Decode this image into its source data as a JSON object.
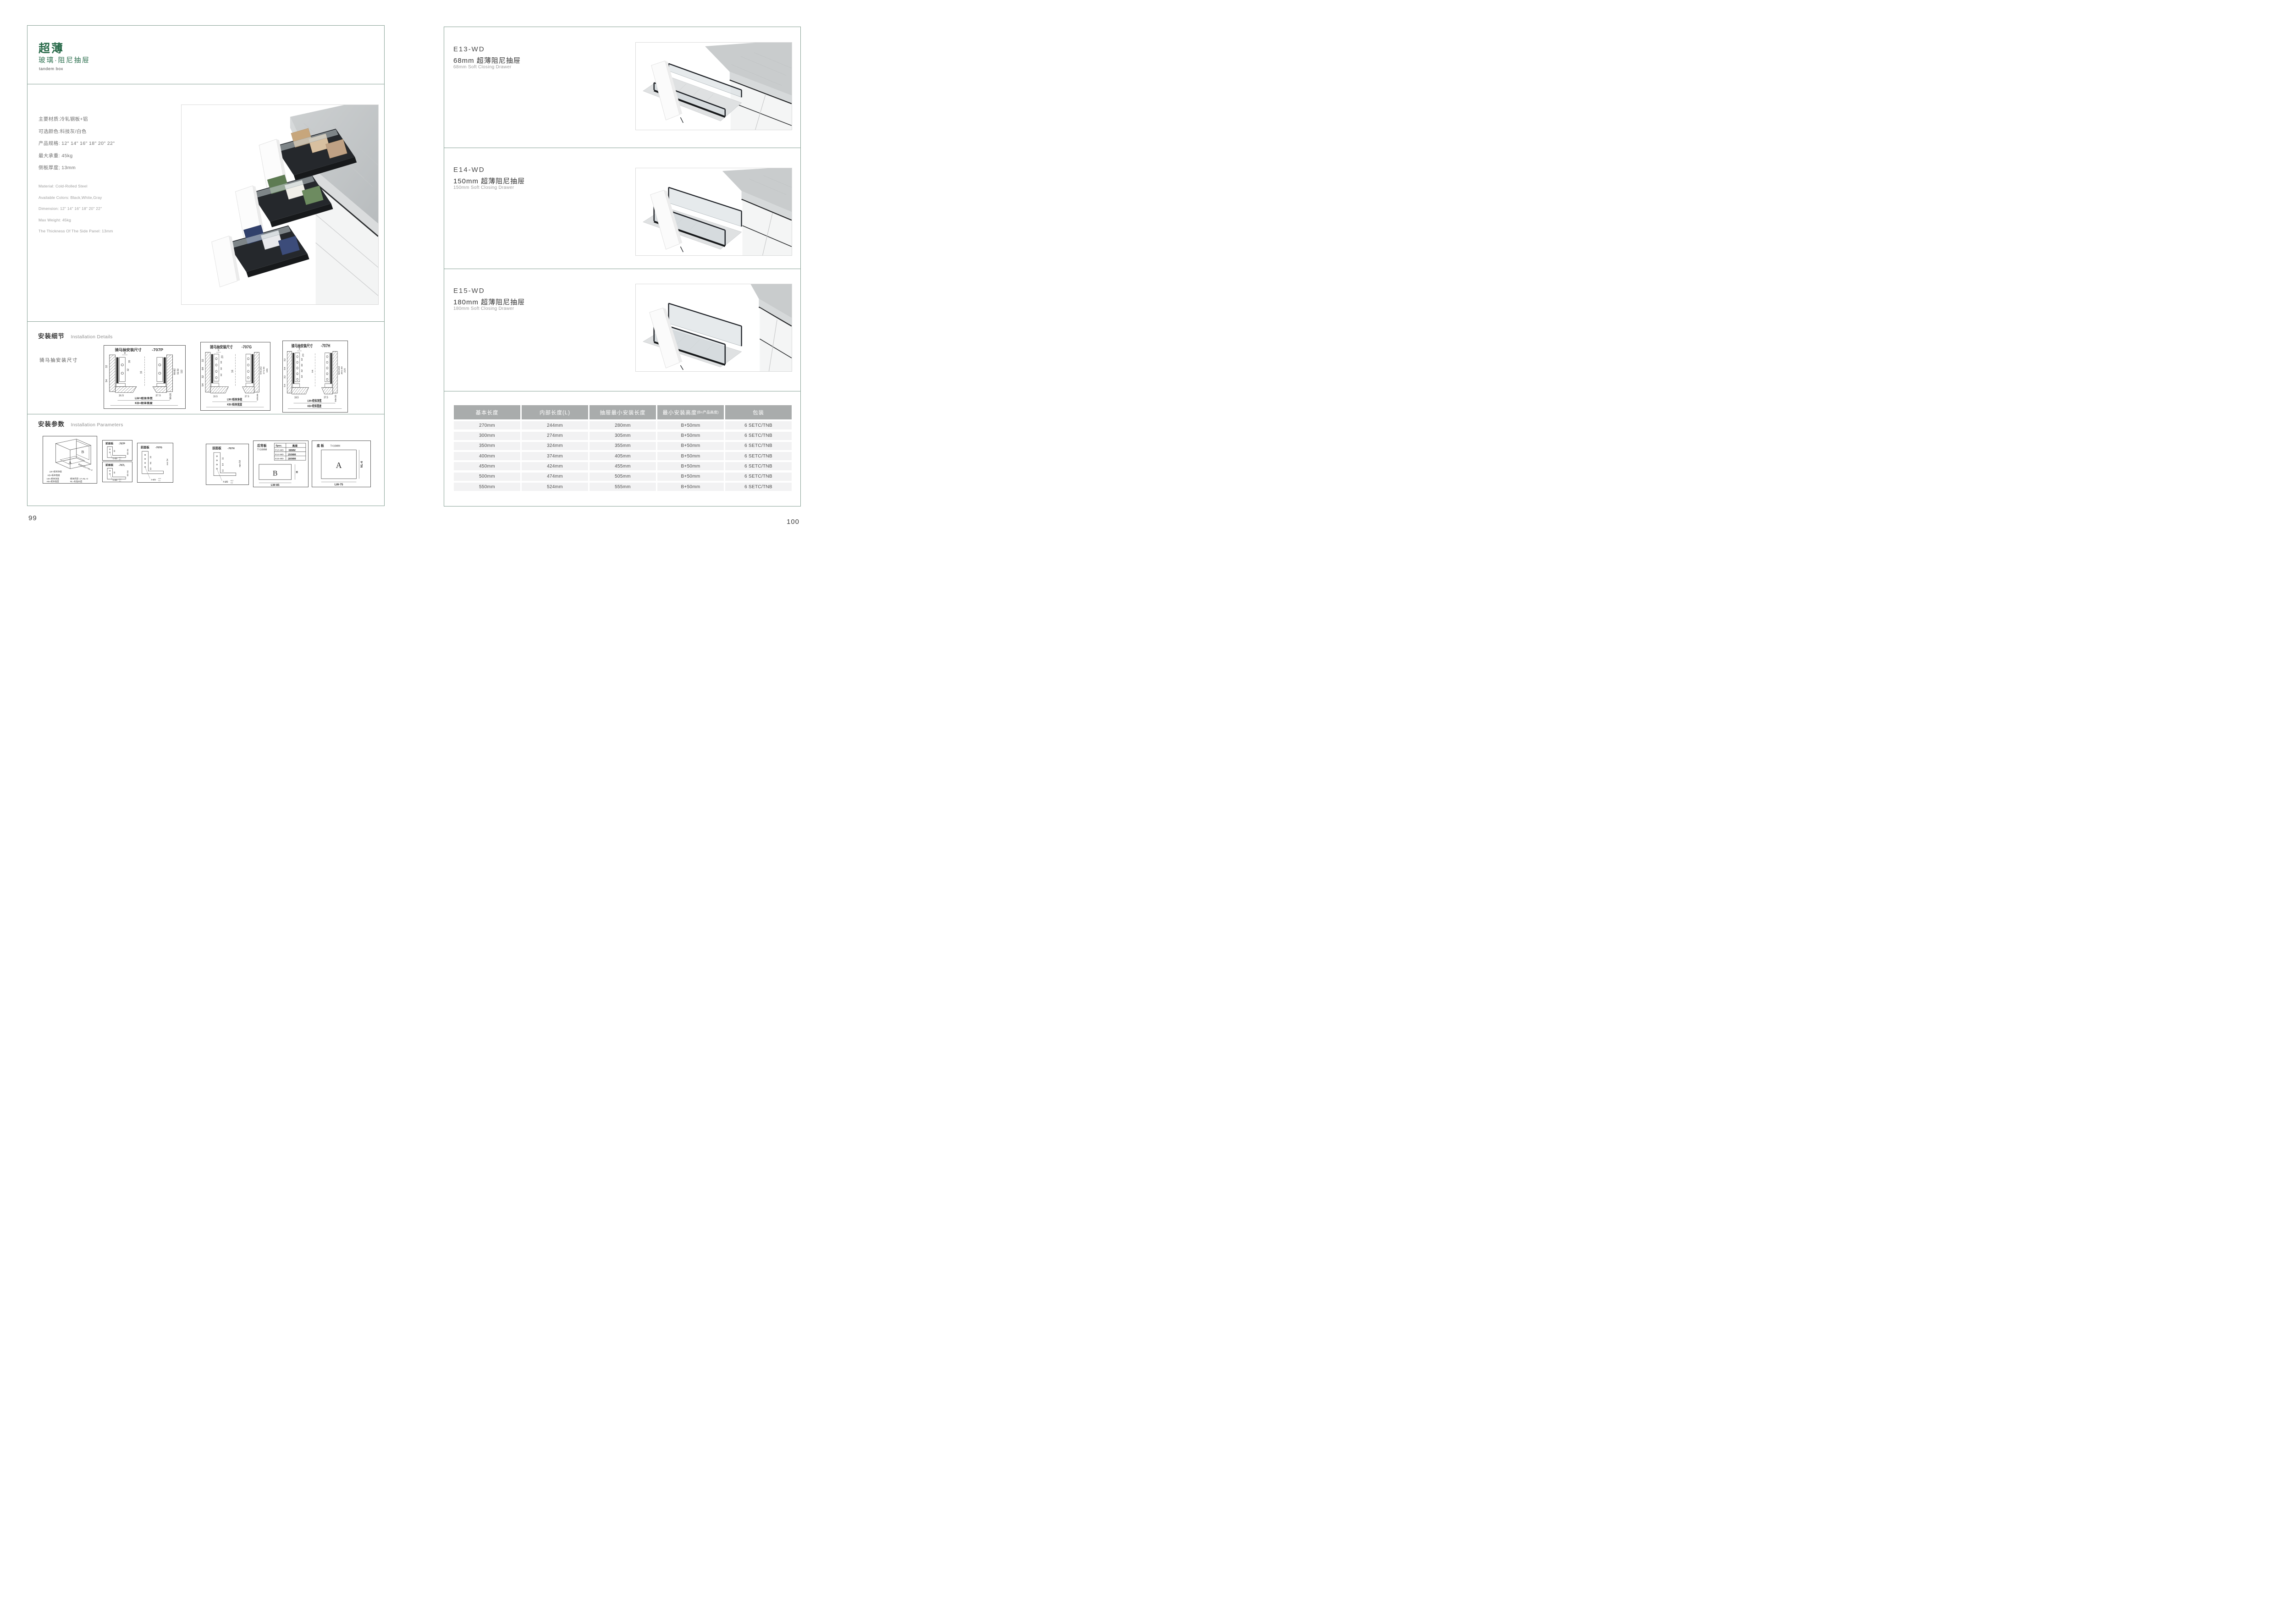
{
  "page": {
    "left_no": "99",
    "right_no": "100"
  },
  "colors": {
    "brand_green": "#2a6b4b",
    "border_green": "#86a094",
    "table_header_bg": "#a9acac",
    "table_row_bg": "#f2f2f3"
  },
  "left": {
    "header": {
      "title": "超薄",
      "subtitle": "玻璃·阻尼抽屉",
      "tagline": "tandem box"
    },
    "specs_cn": [
      "主要材质:冷轧钢板+铝",
      "可选颜色:科技灰/白色",
      "产品规格: 12\" 14\" 16\" 18\" 20\" 22\"",
      "最大承重: 45kg",
      "侧板厚度; 13mm"
    ],
    "specs_en": [
      "Material: Cold-Rolled Steel",
      "Available Colors: Black,White,Gray",
      "Dimension: 12\" 14\" 16\" 18\" 20\" 22\"",
      "Max Weight: 45kg",
      "The Thickness Of The Side Panel: 13mm"
    ],
    "details": {
      "title_cn": "安装细节",
      "title_en": "Installation Details",
      "subtitle": "骑马抽安装尺寸"
    },
    "diagrams": [
      {
        "label": "骑马抽安装尺寸",
        "model": "-707P",
        "top_dims": [
          "9",
          "20"
        ],
        "hole_dims": [
          "32"
        ],
        "left_dims": [
          "32",
          "54"
        ],
        "mid_dim": "16",
        "right_dims": [
          "Min82",
          "91.50",
          "113"
        ],
        "bottom_dims": [
          "16.5",
          "37.5",
          "Min36"
        ],
        "lw": "LW=柜体净宽",
        "kb": "KB=柜体宽度"
      },
      {
        "label": "骑马抽安装尺寸",
        "model": "-707G",
        "top_dims": [
          "9",
          "20"
        ],
        "hole_dims": [
          "32",
          "32",
          "32"
        ],
        "left_dims": [
          "32",
          "64",
          "32",
          "54"
        ],
        "mid_dim": "16",
        "right_dims": [
          "Min162",
          "171.50",
          "195"
        ],
        "bottom_dims": [
          "16.5",
          "37.5",
          "Min36"
        ],
        "lw": "LW=柜体净宽",
        "kb": "KB=柜体宽度"
      },
      {
        "label": "骑马抽安装尺寸",
        "model": "-707H",
        "top_dims": [
          "9",
          "20"
        ],
        "hole_dims": [
          "32",
          "32",
          "32",
          "32"
        ],
        "left_dims": [
          "32",
          "64",
          "32",
          "54"
        ],
        "mid_dim": "16",
        "right_dims": [
          "Min192",
          "201.50",
          "225"
        ],
        "bottom_dims": [
          "16.5",
          "37.5",
          "Min36"
        ],
        "lw": "LW=柜体净宽",
        "kb": "KB=柜体宽度"
      }
    ],
    "params": {
      "title_cn": "安装参数",
      "title_en": "Installation Parameters"
    },
    "iso": {
      "a": "A",
      "b": "B",
      "lw": "LW=柜体净宽",
      "kb": "KB=柜体宽度",
      "lt": "柜体内空LT=NL+3",
      "legend1a": "LW=柜体净宽",
      "legend1b": "柜体内空: LT=NL+3",
      "legend2a": "KB=柜体宽度",
      "legend2b": "NL=标准长度"
    },
    "panels": [
      {
        "title": "前面板",
        "model": "-707P",
        "dim1": "32",
        "min": "min 54",
        "holes": "2-Ø2",
        "tol_up": "+0.2",
        "tol_dn": "-0.1"
      },
      {
        "title": "前面板",
        "model": "-707L",
        "dim1": "32",
        "min": "min 54",
        "holes": "2-Ø2",
        "tol_up": "+0.2",
        "tol_dn": "-0.1"
      },
      {
        "title": "前面板",
        "model": "-707G",
        "dims": [
          "32",
          "64",
          "32"
        ],
        "min": "min 54",
        "holes": "4-Ø2",
        "tol_up": "+0.2",
        "tol_dn": "-0.1"
      },
      {
        "title": "前面板",
        "model": "-707H",
        "dims": [
          "32",
          "64",
          "32"
        ],
        "min": "min 54",
        "holes": "4-Ø2",
        "tol_up": "+0.2",
        "tol_dn": "-0.1"
      }
    ],
    "back_panel": {
      "title": "后背板",
      "t": "T=16MM",
      "spec_col": "Spec.",
      "height_col": "高度",
      "rows": [
        [
          "E13-WD",
          "68MM"
        ],
        [
          "E14-WD",
          "150MM"
        ],
        [
          "E15-WD",
          "180MM"
        ]
      ],
      "letter": "B",
      "h": "H",
      "lw": "LW-85"
    },
    "bottom_panel": {
      "title": "底 板",
      "t": "T=16MM",
      "letter": "A",
      "nl": "NL-6",
      "lw": "LW-75"
    }
  },
  "right": {
    "products": [
      {
        "model": "E13-WD",
        "title_cn": "68mm 超薄阻尼抽屉",
        "title_en": "68mm Soft Closing Drawer"
      },
      {
        "model": "E14-WD",
        "title_cn": "150mm 超薄阻尼抽屉",
        "title_en": "150mm Soft Closing Drawer"
      },
      {
        "model": "E15-WD",
        "title_cn": "180mm 超薄阻尼抽屉",
        "title_en": "180mm Soft Closing Drawer"
      }
    ],
    "table": {
      "headers": [
        "基本长度",
        "内部长度(L)",
        "抽屉最小安装长度",
        "最小安装高度",
        "包装"
      ],
      "header4_note": "(B=产品高度)",
      "rows": [
        [
          "270mm",
          "244mm",
          "280mm",
          "B+50mm",
          "6 SETC/TNB"
        ],
        [
          "300mm",
          "274mm",
          "305mm",
          "B+50mm",
          "6 SETC/TNB"
        ],
        [
          "350mm",
          "324mm",
          "355mm",
          "B+50mm",
          "6 SETC/TNB"
        ],
        [
          "400mm",
          "374mm",
          "405mm",
          "B+50mm",
          "6 SETC/TNB"
        ],
        [
          "450mm",
          "424mm",
          "455mm",
          "B+50mm",
          "6 SETC/TNB"
        ],
        [
          "500mm",
          "474mm",
          "505mm",
          "B+50mm",
          "6 SETC/TNB"
        ],
        [
          "550mm",
          "524mm",
          "555mm",
          "B+50mm",
          "6 SETC/TNB"
        ]
      ]
    }
  }
}
